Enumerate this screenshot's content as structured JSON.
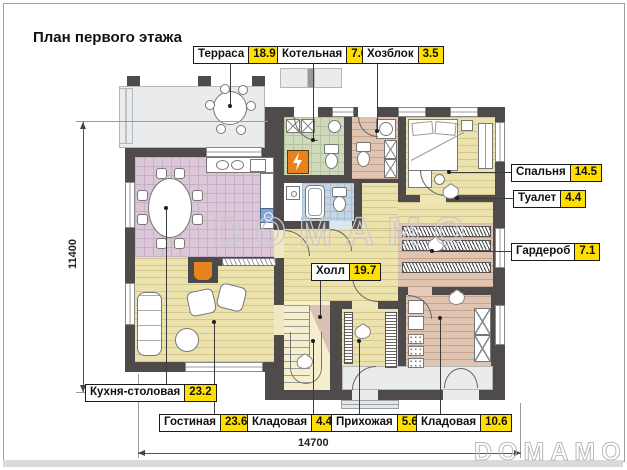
{
  "title": "План первого этажа",
  "watermark": {
    "center": "DOMAMO",
    "corner": "DOMAMO"
  },
  "dimensions": {
    "width_mm": "14700",
    "height_mm": "11400"
  },
  "rooms": [
    {
      "id": "terrace",
      "name": "Терраса",
      "area": "18.9"
    },
    {
      "id": "boiler",
      "name": "Котельная",
      "area": "7.6"
    },
    {
      "id": "utility",
      "name": "Хозблок",
      "area": "3.5"
    },
    {
      "id": "bedroom",
      "name": "Спальня",
      "area": "14.5"
    },
    {
      "id": "toilet",
      "name": "Туалет",
      "area": "4.4"
    },
    {
      "id": "wardrobe",
      "name": "Гардероб",
      "area": "7.1"
    },
    {
      "id": "hall",
      "name": "Холл",
      "area": "19.7"
    },
    {
      "id": "kitchen",
      "name": "Кухня-столовая",
      "area": "23.2"
    },
    {
      "id": "living",
      "name": "Гостиная",
      "area": "23.6"
    },
    {
      "id": "pantry_small",
      "name": "Кладовая",
      "area": "4.4"
    },
    {
      "id": "entry",
      "name": "Прихожая",
      "area": "5.6"
    },
    {
      "id": "pantry_large",
      "name": "Кладовая",
      "area": "10.6"
    }
  ],
  "colors": {
    "area_badge": "#FFDF00",
    "wall": "#4F4B4B",
    "kitchen_tile": "#DBC7D8",
    "boiler_tile": "#CFDABC",
    "bath_tile": "#C4D5E5",
    "wood_yellow": "#ECE2AE",
    "wood_pink": "#E0C4B2",
    "terrace_gray": "#E9EBED",
    "accent_orange": "#E8821E",
    "watermark_gray": "#C7C7CB"
  }
}
